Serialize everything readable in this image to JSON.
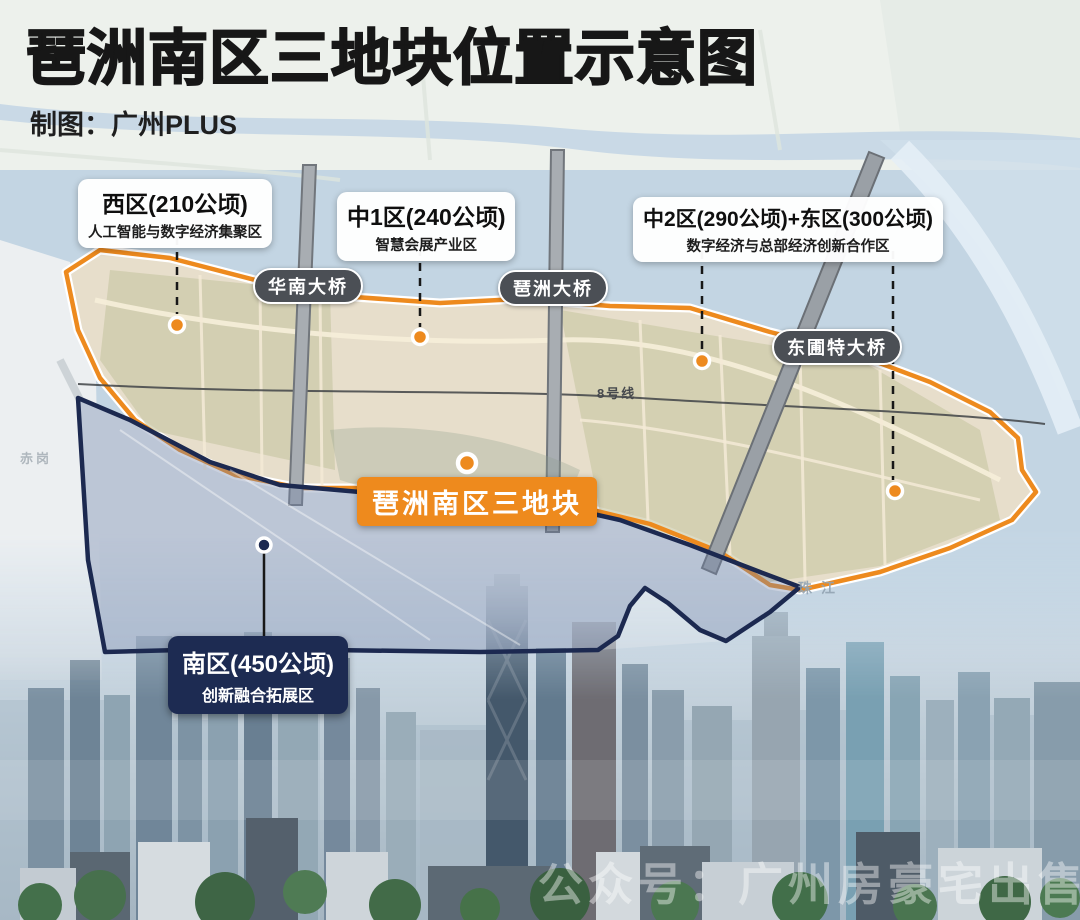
{
  "header": {
    "title": "琶洲南区三地块位置示意图",
    "credit": "制图：广州PLUS"
  },
  "zones": [
    {
      "name": "西区(210公顷)",
      "desc": "人工智能与数字经济集聚区"
    },
    {
      "name": "中1区(240公顷)",
      "desc": "智慧会展产业区"
    },
    {
      "name": "中2区(290公顷)+东区(300公顷)",
      "desc": "数字经济与总部经济创新合作区"
    },
    {
      "name": "南区(450公顷)",
      "desc": "创新融合拓展区"
    }
  ],
  "bridges": [
    {
      "name": "华南大桥"
    },
    {
      "name": "琶洲大桥"
    },
    {
      "name": "东圃特大桥"
    }
  ],
  "center_label": "琶洲南区三地块",
  "map_labels": {
    "metro_line": "8号线",
    "river": "珠江",
    "district": "赤岗"
  },
  "watermark": "公众号：广州房豪宅出售",
  "colors": {
    "accent_orange": "#EE8A1D",
    "navy": "#1C2950",
    "bridge_pill": "#4B4F55",
    "island_fill": "#E7DECB",
    "water": "#C3D5E3"
  }
}
